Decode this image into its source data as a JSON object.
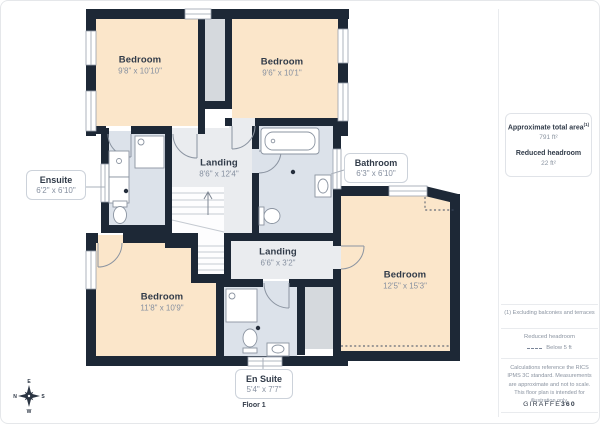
{
  "page": {
    "floor_label": "Floor 1"
  },
  "plan": {
    "rooms": [
      {
        "name": "Bedroom",
        "dims": "9'8\" x 10'10\""
      },
      {
        "name": "Bedroom",
        "dims": "9'6\" x 10'1\""
      },
      {
        "name": "Landing",
        "dims": "8'6\" x 12'4\""
      },
      {
        "name": "Bedroom",
        "dims": "11'8\" x 10'9\""
      },
      {
        "name": "Landing",
        "dims": "6'6\" x 3'2\""
      },
      {
        "name": "Bedroom",
        "dims": "12'5\" x 15'3\""
      }
    ],
    "callouts": [
      {
        "name": "Ensuite",
        "dims": "6'2\" x 6'10\""
      },
      {
        "name": "Bathroom",
        "dims": "6'3\" x 6'10\""
      },
      {
        "name": "En Suite",
        "dims": "5'4\" x 7'7\""
      }
    ],
    "compass": {
      "north": "N",
      "east": "E",
      "south": "S",
      "west": "W"
    }
  },
  "sidebar": {
    "total_area_label": "Approximate total area",
    "total_area_sup": "(1)",
    "total_area_value": "791 ft²",
    "reduced_headroom_label": "Reduced headroom",
    "reduced_headroom_value": "22 ft²",
    "footnote": "(1) Excluding balconies and terraces",
    "legend_title": "Reduced headroom",
    "legend_value": "Below 5 ft",
    "disclaimer": "Calculations reference the RICS IPMS 3C standard. Measurements are approximate and not to scale. This floor plan is intended for illustration only.",
    "brand_name": "GIRAFFE",
    "brand_number": "360"
  },
  "colors": {
    "wall": "#1d2836",
    "bedroom_fill": "#fbe6ca",
    "bathroom_fill": "#dce2ea",
    "landing_fill": "#eaecef",
    "closet_fill": "#d5d9dd",
    "accent_text": "#313b49",
    "muted_text": "#8a93a0"
  }
}
